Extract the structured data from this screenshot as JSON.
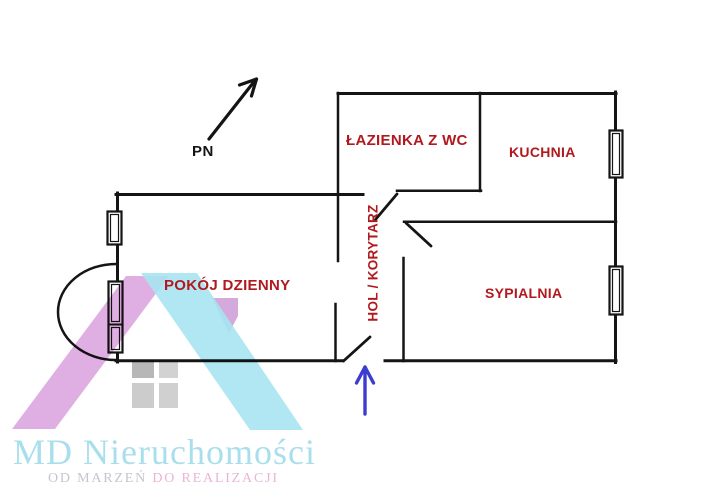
{
  "floor_plan": {
    "north_label": "PN",
    "rooms": [
      {
        "name": "bathroom",
        "label": "ŁAZIENKA Z WC"
      },
      {
        "name": "kitchen",
        "label": "KUCHNIA"
      },
      {
        "name": "living-room",
        "label": "POKÓJ DZIENNY"
      },
      {
        "name": "bedroom",
        "label": "SYPIALNIA"
      },
      {
        "name": "hall",
        "label": "HOL / KORYTARZ"
      }
    ],
    "colors": {
      "wall": "#151515",
      "room_label": "#b2191e",
      "entrance_arrow": "#3c3ccf"
    }
  },
  "branding": {
    "logo_text": "MD Nieruchomości",
    "tagline_left": "OD MARZEŃ",
    "tagline_right": "DO REALIZACJI",
    "colors": {
      "logo_text": "#a9dfec",
      "tagline_left": "#c9c3ce",
      "tagline_right": "#eab4d8",
      "watermark_roof_pink": "#dba6e0",
      "watermark_roof_cyan": "#a7e4f1",
      "watermark_window_gray": "#c6c6c6"
    }
  }
}
